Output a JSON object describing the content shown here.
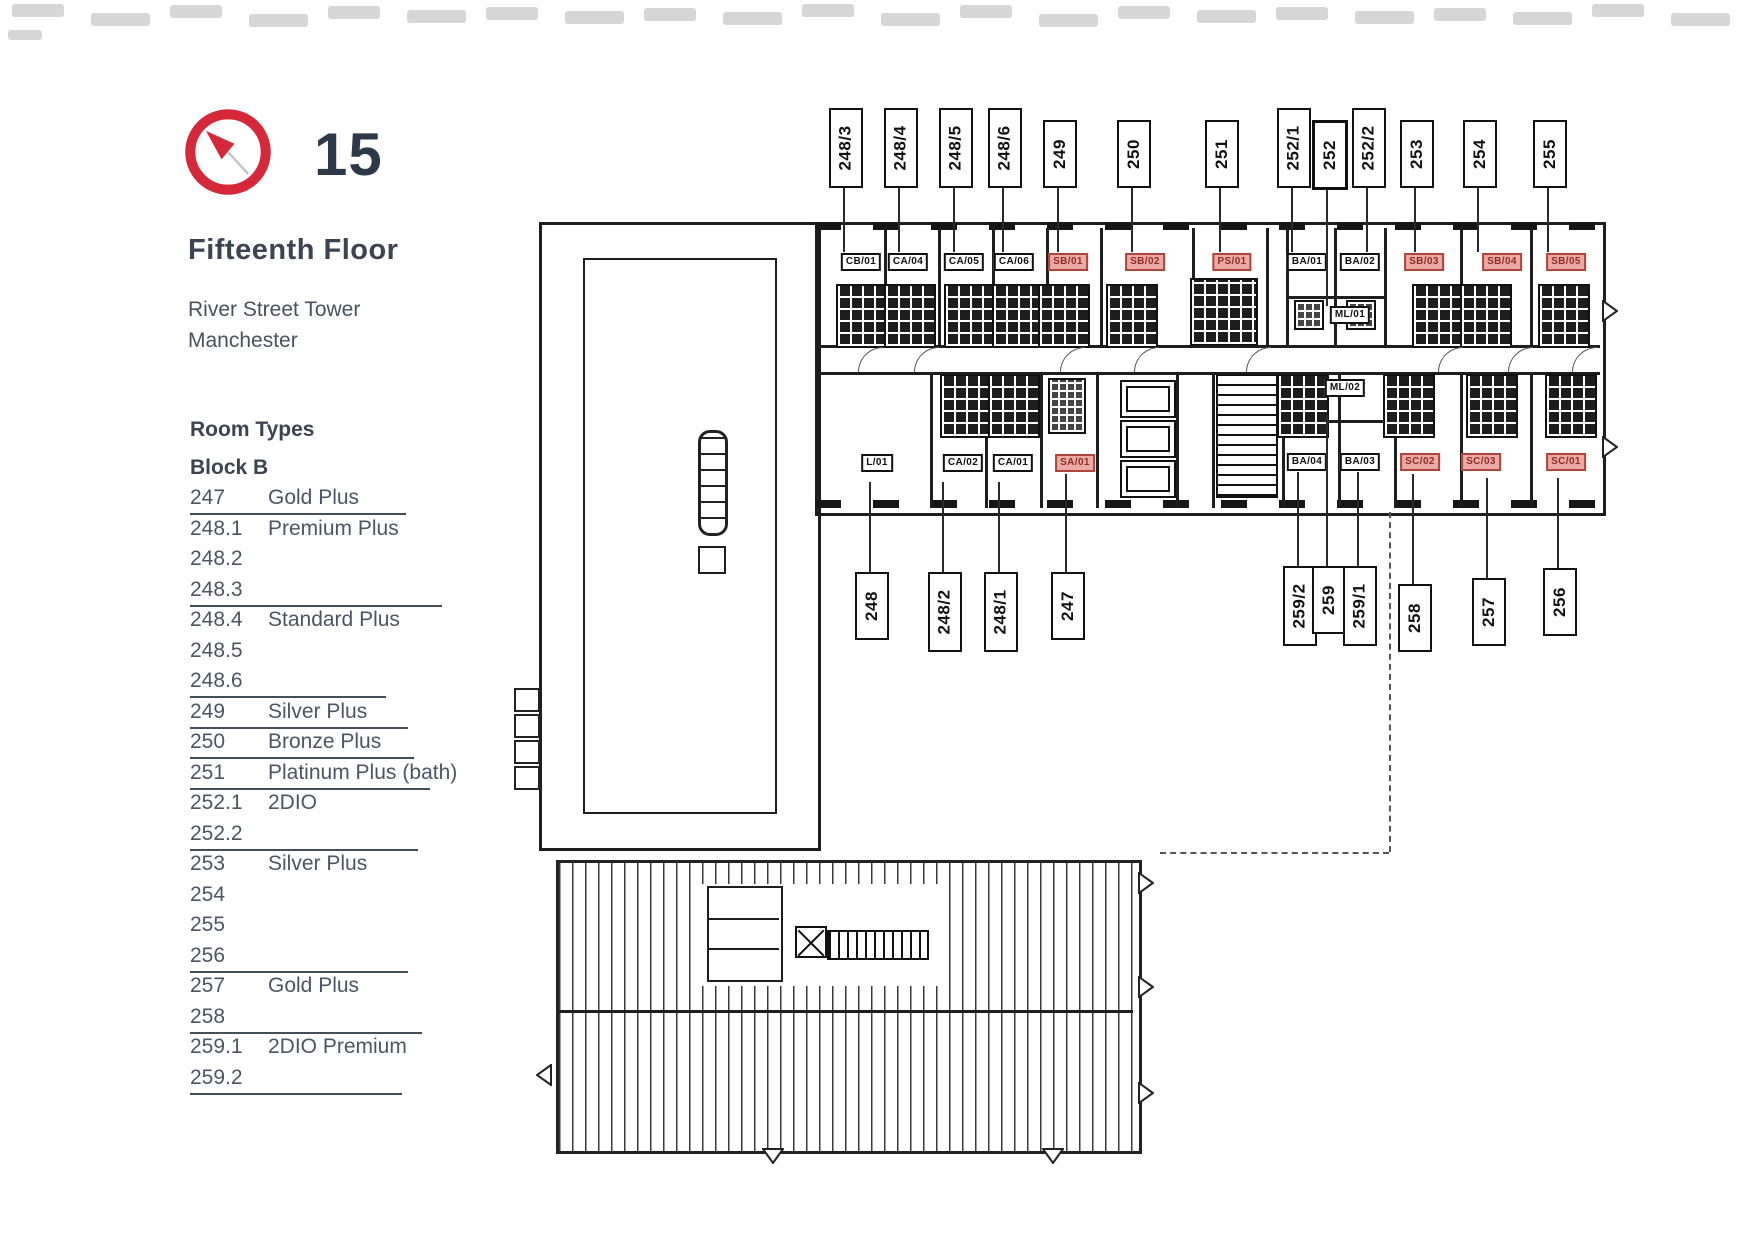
{
  "header": {
    "floor_number": "15",
    "floor_name": "Fifteenth Floor",
    "building": "River Street Tower",
    "city": "Manchester"
  },
  "room_types": {
    "heading": "Room Types",
    "block": "Block B",
    "rows": [
      {
        "num": "247",
        "type": "Gold Plus",
        "u": 216
      },
      {
        "num": "248.1",
        "type": "Premium Plus"
      },
      {
        "num": "248.2",
        "type": ""
      },
      {
        "num": "248.3",
        "type": "",
        "u": 252
      },
      {
        "num": "248.4",
        "type": "Standard Plus"
      },
      {
        "num": "248.5",
        "type": ""
      },
      {
        "num": "248.6",
        "type": "",
        "u": 196
      },
      {
        "num": "249",
        "type": "Silver Plus",
        "u": 218
      },
      {
        "num": "250",
        "type": "Bronze Plus",
        "u": 224
      },
      {
        "num": "251",
        "type": "Platinum Plus",
        "suffix": "(bath)",
        "u": 240
      },
      {
        "num": "252.1",
        "type": "2DIO"
      },
      {
        "num": "252.2",
        "type": "",
        "u": 228
      },
      {
        "num": "253",
        "type": "Silver Plus"
      },
      {
        "num": "254",
        "type": ""
      },
      {
        "num": "255",
        "type": ""
      },
      {
        "num": "256",
        "type": "",
        "u": 218
      },
      {
        "num": "257",
        "type": "Gold Plus"
      },
      {
        "num": "258",
        "type": "",
        "u": 232
      },
      {
        "num": "259.1",
        "type": "2DIO Premium"
      },
      {
        "num": "259.2",
        "type": "",
        "u": 212
      }
    ]
  },
  "plan": {
    "top_labels": [
      {
        "text": "248/3",
        "x": 844,
        "h": 76,
        "end": 252
      },
      {
        "text": "248/4",
        "x": 899,
        "h": 76,
        "end": 252
      },
      {
        "text": "248/5",
        "x": 954,
        "h": 76,
        "end": 252
      },
      {
        "text": "248/6",
        "x": 1003,
        "h": 76,
        "end": 252
      },
      {
        "text": "249",
        "x": 1058,
        "h": 64,
        "end": 252
      },
      {
        "text": "250",
        "x": 1132,
        "h": 64,
        "end": 252
      },
      {
        "text": "251",
        "x": 1220,
        "h": 64,
        "end": 252
      },
      {
        "text": "252/1",
        "x": 1292,
        "h": 76,
        "end": 252
      },
      {
        "text": "252",
        "x": 1327,
        "h": 64,
        "end": 306,
        "bold": true
      },
      {
        "text": "252/2",
        "x": 1367,
        "h": 76,
        "end": 252
      },
      {
        "text": "253",
        "x": 1415,
        "h": 64,
        "end": 252
      },
      {
        "text": "254",
        "x": 1478,
        "h": 64,
        "end": 252
      },
      {
        "text": "255",
        "x": 1548,
        "h": 64,
        "end": 252
      }
    ],
    "bottom_labels": [
      {
        "text": "248",
        "x": 870,
        "y": 572,
        "h": 64,
        "end": 482
      },
      {
        "text": "248/2",
        "x": 943,
        "y": 572,
        "h": 76,
        "end": 482
      },
      {
        "text": "248/1",
        "x": 999,
        "y": 572,
        "h": 76,
        "end": 482
      },
      {
        "text": "247",
        "x": 1066,
        "y": 572,
        "h": 64,
        "end": 474
      },
      {
        "text": "259/2",
        "x": 1298,
        "y": 566,
        "h": 76,
        "end": 472
      },
      {
        "text": "259",
        "x": 1327,
        "y": 566,
        "h": 64,
        "end": 415
      },
      {
        "text": "259/1",
        "x": 1358,
        "y": 566,
        "h": 76,
        "end": 472
      },
      {
        "text": "258",
        "x": 1413,
        "y": 584,
        "h": 64,
        "end": 474
      },
      {
        "text": "257",
        "x": 1487,
        "y": 578,
        "h": 64,
        "end": 478
      },
      {
        "text": "256",
        "x": 1558,
        "y": 568,
        "h": 64,
        "end": 478
      }
    ],
    "unit_labels": [
      {
        "text": "CB/01",
        "x": 861,
        "y": 262,
        "style": "black"
      },
      {
        "text": "CA/04",
        "x": 908,
        "y": 262,
        "style": "black"
      },
      {
        "text": "CA/05",
        "x": 964,
        "y": 262,
        "style": "black"
      },
      {
        "text": "CA/06",
        "x": 1014,
        "y": 262,
        "style": "black"
      },
      {
        "text": "SB/01",
        "x": 1068,
        "y": 262,
        "style": "red"
      },
      {
        "text": "SB/02",
        "x": 1145,
        "y": 262,
        "style": "red"
      },
      {
        "text": "PS/01",
        "x": 1232,
        "y": 262,
        "style": "red"
      },
      {
        "text": "BA/01",
        "x": 1307,
        "y": 262,
        "style": "black"
      },
      {
        "text": "BA/02",
        "x": 1360,
        "y": 262,
        "style": "black"
      },
      {
        "text": "SB/03",
        "x": 1424,
        "y": 262,
        "style": "red"
      },
      {
        "text": "SB/04",
        "x": 1502,
        "y": 262,
        "style": "red"
      },
      {
        "text": "SB/05",
        "x": 1566,
        "y": 262,
        "style": "red"
      },
      {
        "text": "ML/01",
        "x": 1350,
        "y": 315,
        "style": "black"
      },
      {
        "text": "L/01",
        "x": 877,
        "y": 463,
        "style": "black"
      },
      {
        "text": "CA/02",
        "x": 963,
        "y": 463,
        "style": "black"
      },
      {
        "text": "CA/01",
        "x": 1013,
        "y": 463,
        "style": "black"
      },
      {
        "text": "SA/01",
        "x": 1075,
        "y": 463,
        "style": "red"
      },
      {
        "text": "ML/02",
        "x": 1345,
        "y": 388,
        "style": "black"
      },
      {
        "text": "BA/04",
        "x": 1307,
        "y": 462,
        "style": "black"
      },
      {
        "text": "BA/03",
        "x": 1360,
        "y": 462,
        "style": "black"
      },
      {
        "text": "SC/02",
        "x": 1420,
        "y": 462,
        "style": "red"
      },
      {
        "text": "SC/03",
        "x": 1481,
        "y": 462,
        "style": "red"
      },
      {
        "text": "SC/01",
        "x": 1566,
        "y": 462,
        "style": "red"
      }
    ]
  },
  "colors": {
    "accent": "#d5293a",
    "ink": "#1e1e1e",
    "text_dark": "#2d3849",
    "text_mid": "#4b5662",
    "red_label_bg": "#eda9a3",
    "red_label_border": "#ae453c",
    "red_label_text": "#8d2d26"
  }
}
